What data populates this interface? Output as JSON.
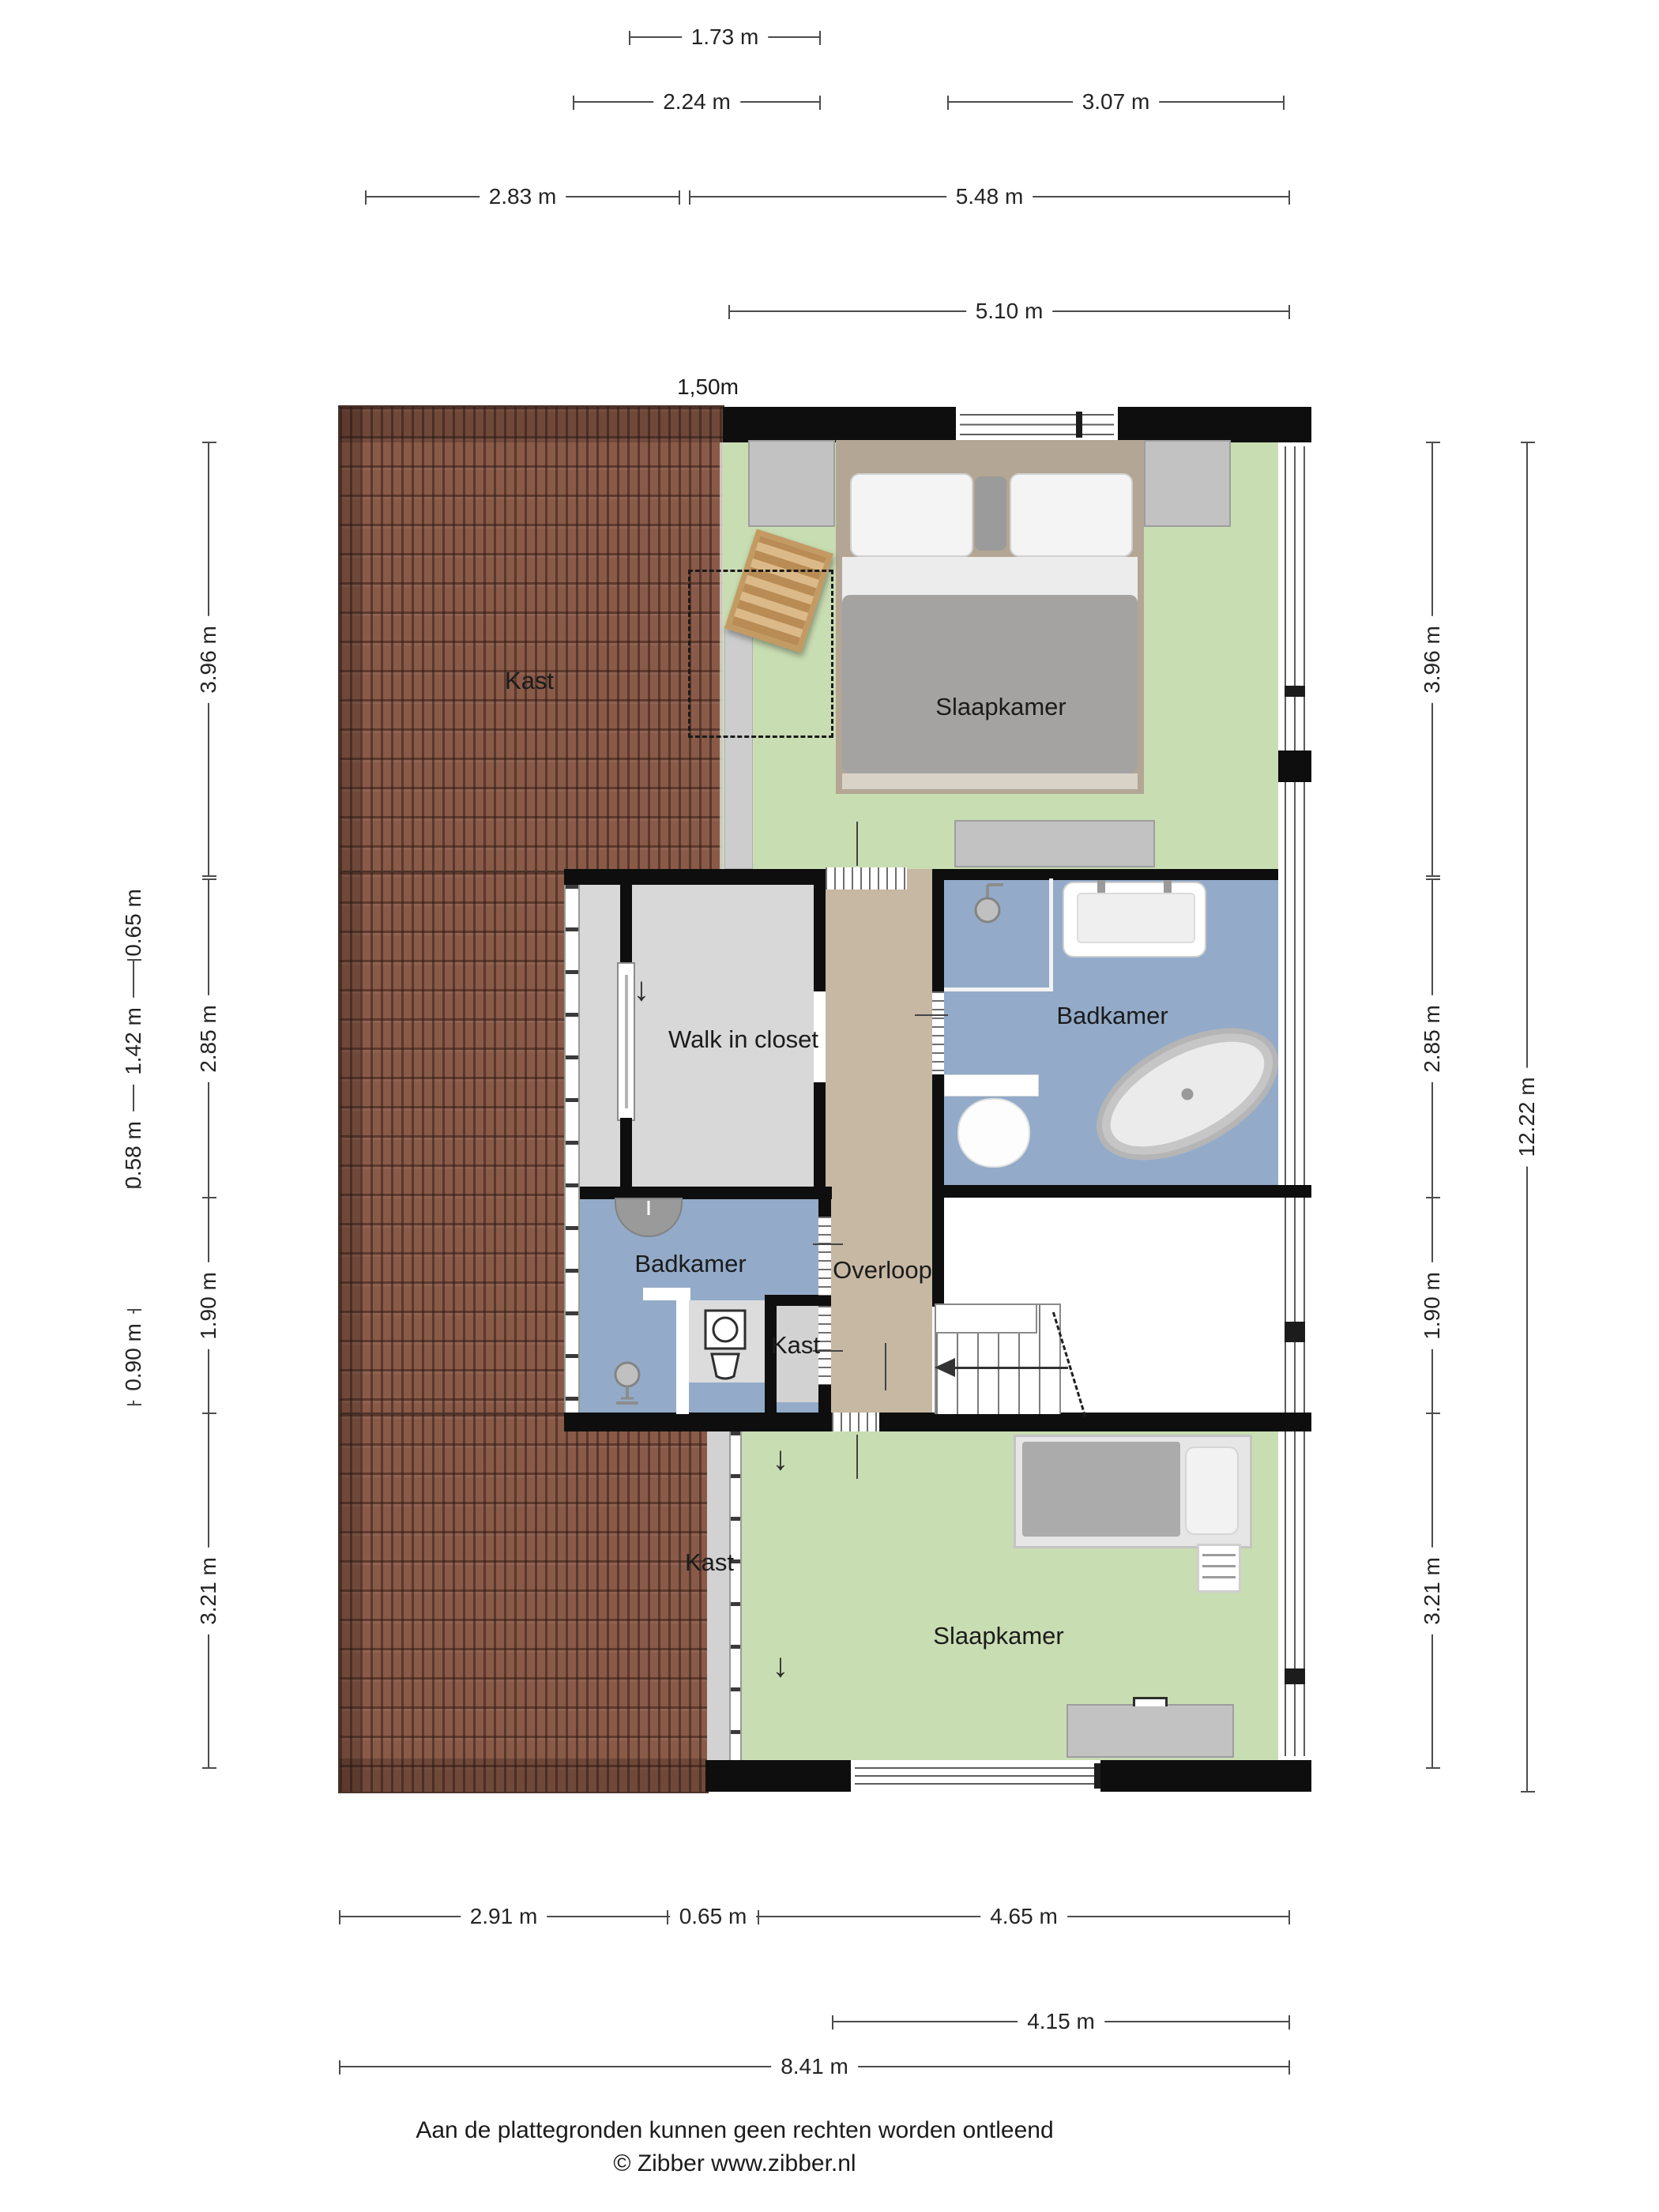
{
  "plan": {
    "marker_150": "1,50m",
    "rooms": {
      "kast_roof": "Kast",
      "slaapkamer_top": "Slaapkamer",
      "walk_in_closet": "Walk in closet",
      "badkamer_top": "Badkamer",
      "overloop": "Overloop",
      "badkamer_bottom": "Badkamer",
      "kast_mid": "Kast",
      "kast_bottom": "Kast",
      "slaapkamer_bottom": "Slaapkamer"
    },
    "icons": [
      "bed",
      "nightstand",
      "dresser",
      "chair",
      "shower-head",
      "sink",
      "bathtub",
      "toilet",
      "washing-machine",
      "stairs",
      "ladder",
      "desk"
    ]
  },
  "dims": {
    "d173": "1.73 m",
    "d224": "2.24 m",
    "d307": "3.07 m",
    "d283": "2.83 m",
    "d548": "5.48 m",
    "d510": "5.10 m",
    "l396": "3.96 m",
    "l285": "2.85 m",
    "l190": "1.90 m",
    "l321": "3.21 m",
    "o065": "0.65 m",
    "o142": "1.42 m",
    "o058": "0.58 m",
    "o090": "0.90 m",
    "r396": "3.96 m",
    "r285": "2.85 m",
    "r190": "1.90 m",
    "r321": "3.21 m",
    "r1222": "12.22 m",
    "b291": "2.91 m",
    "b065": "0.65 m",
    "b465": "4.65 m",
    "b415": "4.15 m",
    "b841": "8.41 m"
  },
  "footer": {
    "disclaimer": "Aan de plattegronden kunnen geen rechten worden ontleend",
    "copyright": "© Zibber www.zibber.nl"
  },
  "colors": {
    "roof": "#8a5a48",
    "bedroom_green": "#c9ddb2",
    "bathroom_blue": "#93abc9",
    "landing_tan": "#c7b8a4",
    "closet_gray": "#d8d8d8",
    "wall_black": "#0e0e0e"
  }
}
